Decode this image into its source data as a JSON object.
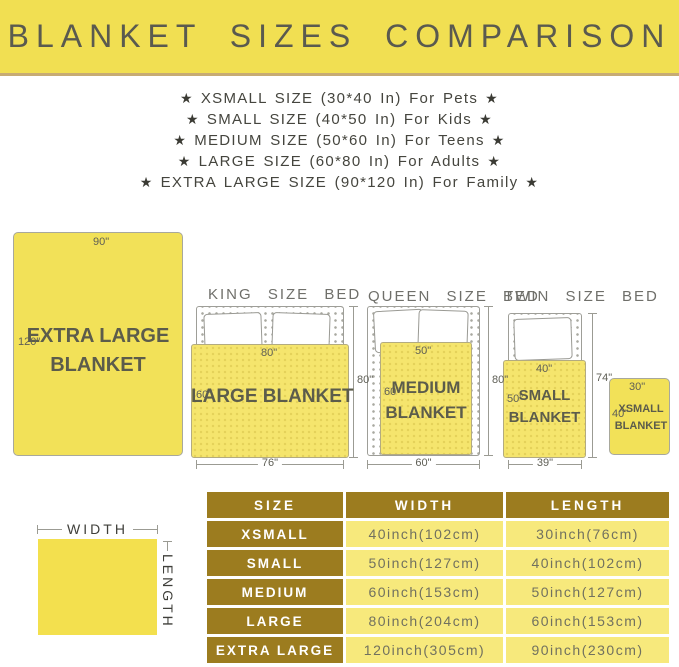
{
  "banner": {
    "title": "BLANKET SIZES COMPARISON"
  },
  "glyphs": {
    "star": "★"
  },
  "size_list": [
    "XSMALL SIZE (30*40 In) For Pets",
    "SMALL SIZE (40*50 In) For Kids",
    "MEDIUM SIZE (50*60 In) For Teens",
    "LARGE SIZE (60*80 In) For Adults",
    "EXTRA LARGE SIZE (90*120 In) For Family"
  ],
  "diagrams": {
    "extra_large": {
      "width_label": "90\"",
      "length_label": "120\"",
      "name_line1": "EXTRA LARGE",
      "name_line2": "BLANKET"
    },
    "king": {
      "title": "KING SIZE BED",
      "blanket_width": "80\"",
      "blanket_length": "60\"",
      "blanket_name": "LARGE BLANKET",
      "bed_length": "80\"",
      "bed_width": "76\""
    },
    "queen": {
      "title": "QUEEN SIZE BED",
      "blanket_width": "50\"",
      "blanket_length": "60\"",
      "name_line1": "MEDIUM",
      "name_line2": "BLANKET",
      "bed_length": "80\"",
      "bed_width": "60\""
    },
    "twin": {
      "title": "TWIN SIZE BED",
      "blanket_width": "40\"",
      "blanket_length": "50\"",
      "name_line1": "SMALL",
      "name_line2": "BLANKET",
      "bed_length": "74\"",
      "bed_width": "39\""
    },
    "xsmall": {
      "width_label": "30\"",
      "length_label": "40\"",
      "name_line1": "XSMALL",
      "name_line2": "BLANKET"
    }
  },
  "legend": {
    "width_label": "WIDTH",
    "length_label": "LENGTH"
  },
  "table": {
    "headers": [
      "SIZE",
      "WIDTH",
      "LENGTH"
    ],
    "rows": [
      {
        "size": "XSMALL",
        "width": "40inch(102cm)",
        "length": "30inch(76cm)"
      },
      {
        "size": "SMALL",
        "width": "50inch(127cm)",
        "length": "40inch(102cm)"
      },
      {
        "size": "MEDIUM",
        "width": "60inch(153cm)",
        "length": "50inch(127cm)"
      },
      {
        "size": "LARGE",
        "width": "80inch(204cm)",
        "length": "60inch(153cm)"
      },
      {
        "size": "EXTRA LARGE",
        "width": "120inch(305cm)",
        "length": "90inch(230cm)"
      }
    ]
  },
  "colors": {
    "banner_yellow": "#f1df52",
    "banner_border": "#c7ab74",
    "blanket_yellow": "#f2e158",
    "table_gold": "#9c7c1f",
    "table_light_yellow": "#f7e97c"
  }
}
